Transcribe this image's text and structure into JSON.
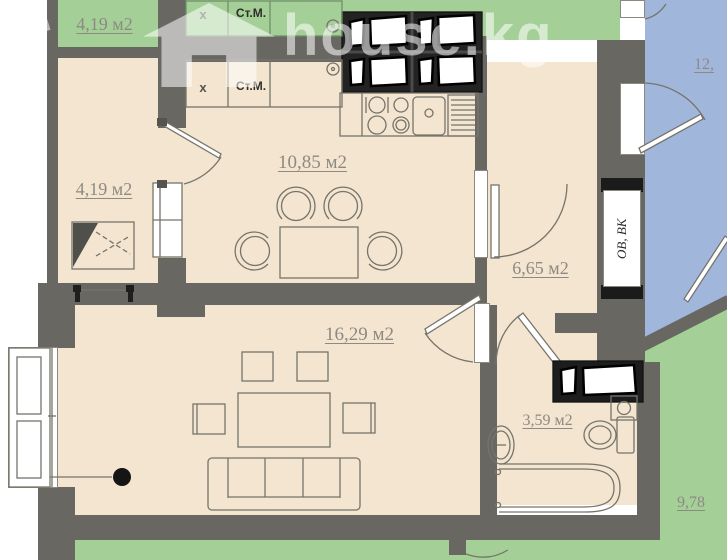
{
  "watermark": {
    "text": "house.kg",
    "icon": "house-icon"
  },
  "rooms": {
    "upper_storage": "4,19 м2",
    "storage": "4,19 м2",
    "kitchen": "10,85 м2",
    "hallway": "6,65 м2",
    "living": "16,29 м2",
    "bathroom": "3,59 м2",
    "neighbor_right": "12,",
    "neighbor_bottom": "9,78"
  },
  "annotations": {
    "upper_x": "х",
    "upper_washer": "Ст.М.",
    "kitchen_x": "х",
    "kitchen_washer": "Ст.М.",
    "shaft": "ОВ, ВК"
  },
  "colors": {
    "wall": "#686762",
    "floor": "#f3e5cf",
    "balcony_green": "#a4d098",
    "neighbor_blue": "#a1b6db",
    "vent_block": "#1d1d1d",
    "label_gray": "#8e8a82"
  }
}
